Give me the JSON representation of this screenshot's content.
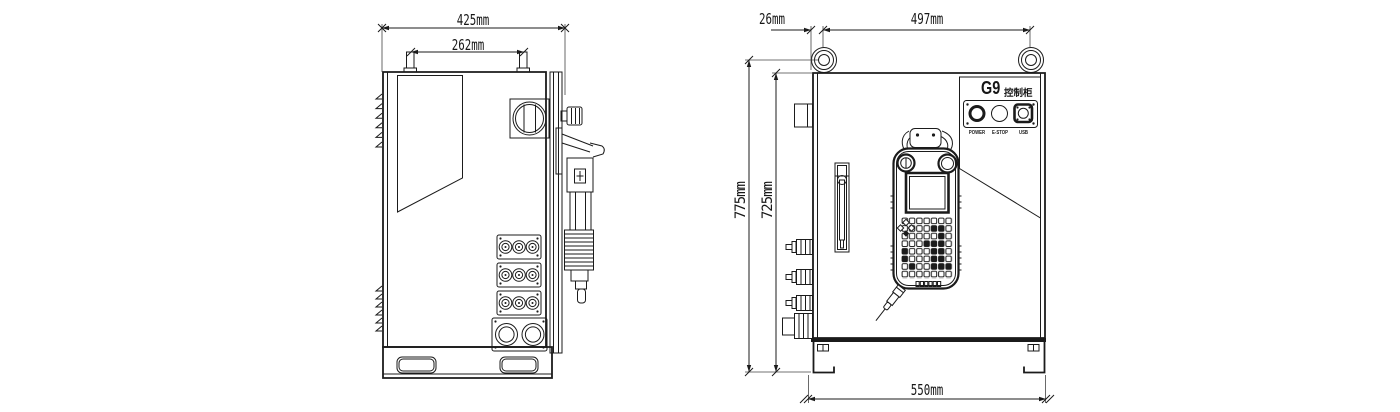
{
  "dims": {
    "side_total_depth": "425mm",
    "side_lug_spacing": "262mm",
    "front_lug_offset": "26mm",
    "front_lug_spacing": "497mm",
    "front_total_height": "775mm",
    "front_body_height": "725mm",
    "front_width": "550mm"
  },
  "nameplate": {
    "model": "G9",
    "type_label": "控制柜",
    "power": "POWER",
    "estop": "E-STOP",
    "usb": "USB"
  },
  "colors": {
    "line": "#1b1b1b",
    "background": "#ffffff"
  }
}
